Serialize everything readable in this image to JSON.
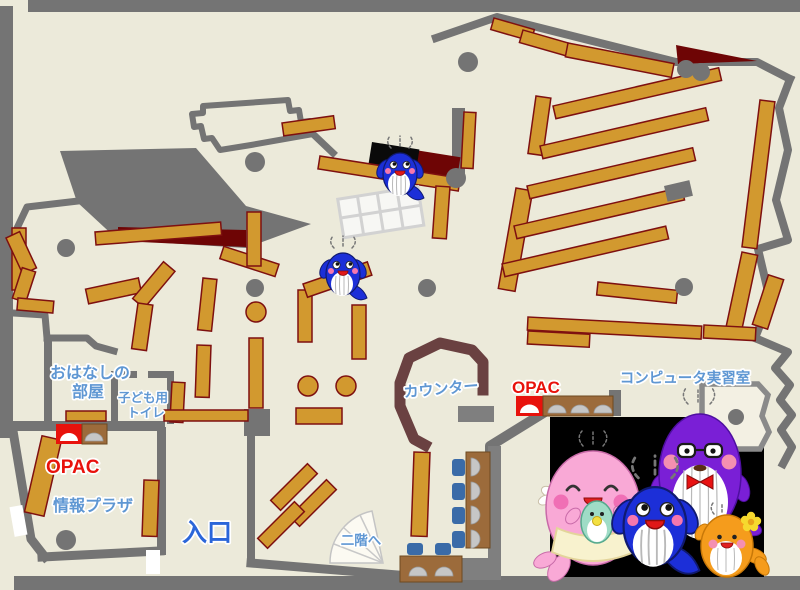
{
  "labels": {
    "storytime_line1": "おはなしの",
    "storytime_line2": "部屋",
    "toilet_line1": "子ども用",
    "toilet_line2": "トイレ",
    "opac_left": "OPAC",
    "opac_right": "OPAC",
    "counter": "カウンター",
    "computer_room": "コンピュータ実習室",
    "info_plaza": "情報プラザ",
    "entrance": "入口",
    "second_floor": "二階へ"
  },
  "colors": {
    "floor": "#ECEADA",
    "wall": "#747474",
    "bookshelf": "#D2992F",
    "bookshelf_border": "#7E1010",
    "restricted_area": "#6E0505",
    "counter": "#6A4141",
    "desk": "#9C6B3B",
    "chair": "#3A6BA8",
    "label_blue": "#5F97D3",
    "entrance_blue": "#2B66D9",
    "opac_red": "#E8120C",
    "mascot_panel": "#000000"
  },
  "mascots": {
    "on_map": [
      "blue-whale-mascot-icon",
      "blue-whale-mascot-icon"
    ],
    "family_panel": [
      "pink-mother-whale-icon",
      "blue-child-whale-icon",
      "purple-father-whale-icon",
      "orange-child-whale-icon"
    ]
  }
}
